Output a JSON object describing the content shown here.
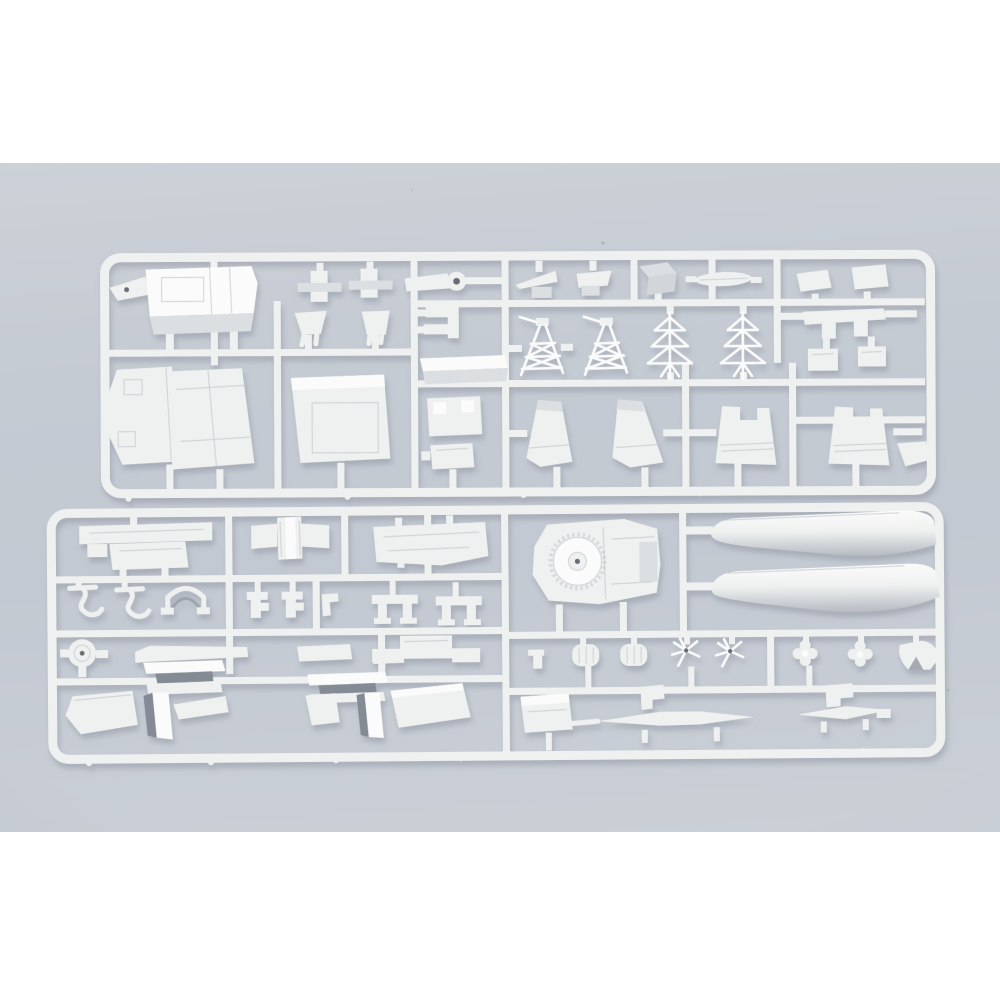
{
  "photo": {
    "alt": "Product photograph of two injection-moulded white polystyrene sprues (part runners) of a plastic ship model kit lying on a pale blue-grey surface"
  },
  "colors": {
    "page-bg": "#ffffff",
    "photo-top": "#cdd1d8",
    "photo-mid": "#c5cbd3",
    "photo-low": "#c3c9d2",
    "photo-bottom": "#cbd0d7",
    "plastic": "#eff1f0",
    "plastic-bright": "#fafbfa",
    "plastic-shade": "#dcdfe1",
    "plastic-dark": "#d2d6d9",
    "float-shade": "#b5bbc2",
    "panel": "#b9bec5",
    "hole": "#676d75",
    "doorway": "#848b94",
    "shadow": "#8b919c",
    "speck": "#9aa2ac"
  },
  "sprues": [
    {
      "id": "sprue-upper",
      "parts": [
        "superstructure-deckhouse",
        "bow-tip",
        "deck-clip-a",
        "deck-clip-b",
        "catapult-arm",
        "wing-wedge-a",
        "wing-wedge-b",
        "casing-box",
        "ships-boat",
        "rudder-plate-a",
        "rudder-plate-b",
        "bracket-u",
        "vent-cowl-a",
        "vent-cowl-b",
        "c-bracket",
        "lattice-tower-a",
        "lattice-tower-b",
        "lattice-mast-a",
        "lattice-mast-b",
        "hull-side-a",
        "hull-side-b",
        "hangar-roof",
        "deckhouse-strip",
        "fitting-plate",
        "fitting-box",
        "funnel-a",
        "funnel-b",
        "notched-casing-a",
        "notched-casing-b",
        "corner-plate",
        "block-a",
        "block-b"
      ]
    },
    {
      "id": "sprue-lower",
      "parts": [
        "winged-deck",
        "cross-deck",
        "boat-deck",
        "barbette-platform",
        "hull-blister-upper",
        "hull-blister-lower",
        "davit-a",
        "davit-b",
        "arch-support",
        "clip-a",
        "clip-b",
        "clip-c",
        "stand-a",
        "stand-b",
        "searchlight-disc",
        "boat-skid-a",
        "shelter-a",
        "ramp-a",
        "hangar-door-a",
        "wedge-a",
        "boat-skid-b",
        "shelter-b",
        "ramp-b",
        "hangar-door-b",
        "wedge-b",
        "deck-bar",
        "anchor-fitting",
        "fairlead-a",
        "fairlead-b",
        "propeller-a",
        "propeller-b",
        "propeller-c",
        "propeller-d",
        "ventilator-cowl",
        "equipment-box",
        "step-plate-a",
        "step-plate-b",
        "yardarm-a",
        "yardarm-b"
      ]
    }
  ]
}
